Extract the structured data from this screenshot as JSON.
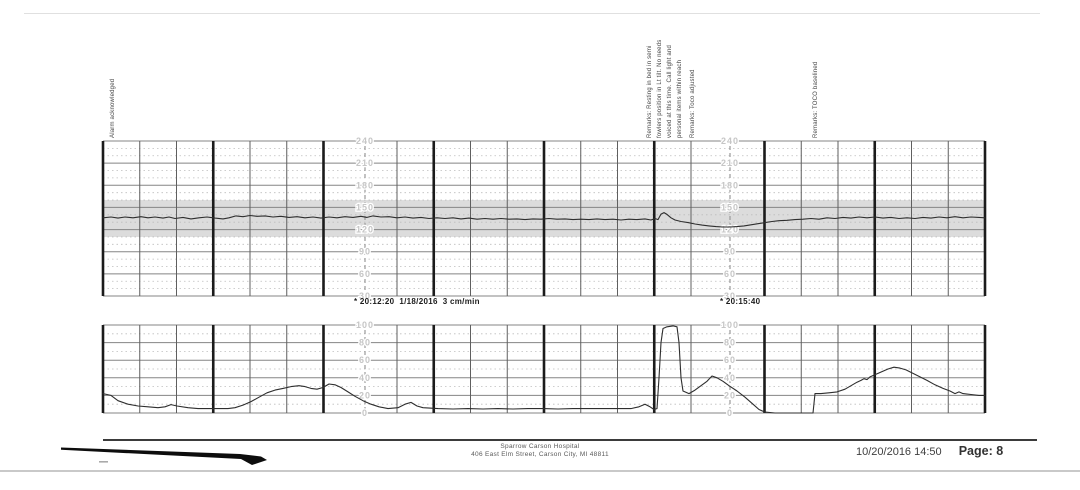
{
  "page": {
    "kind": "Scanned fetal monitoring strip printout",
    "annotations": {
      "alarm": "Alarm acknowledged",
      "remarks_block": [
        "Remarks: Resting in bed in semi",
        "fowlers position in Lt tilt. No needs",
        "voiced at this time. Call light and",
        "personal items within reach",
        "Remarks: Toco adjusted"
      ],
      "toco_baseline": "Remarks: TOCO baselined"
    },
    "strip_labels": {
      "timestamp_left": "* 20:12:20  1/18/2016  3 cm/min",
      "timestamp_right": "* 20:15:40"
    },
    "footer": {
      "hospital_name": "Sparrow Carson Hospital",
      "hospital_address": "406 East Elm Street, Carson City, MI  48811",
      "print_datetime": "10/20/2016 14:50",
      "page_label": "Page: 8"
    }
  },
  "chart_data": [
    {
      "id": "fhr",
      "name": "Fetal heart rate (FHR) strip",
      "type": "line",
      "unit": "bpm",
      "ylim": [
        30,
        240
      ],
      "y_major_ticks": [
        240,
        210,
        180,
        150,
        120,
        90,
        60,
        30
      ],
      "y_minor_step": 10,
      "normal_band": [
        110,
        160
      ],
      "band_color": "#dcdcdc",
      "paper_speed": "3 cm/min",
      "x_major_interval": "1 min",
      "x_minor_interval": "20 s",
      "x_range": [
        0,
        882
      ],
      "x_grid": {
        "major_count": 8,
        "minor_per_major": 3
      },
      "dashed_x": [
        262,
        627
      ],
      "dashed_x_times": [
        "20:12:20",
        "20:15:40"
      ],
      "trace_color": "#2e2e2e",
      "grid_colors": {
        "major_h": "#858585",
        "minor_h": "#bdbdbd",
        "major_v": "#1b1b1b",
        "minor_v": "#5f5f5f",
        "dashed": "#9a9a9a"
      },
      "series": [
        {
          "name": "FHR",
          "points": [
            [
              0,
              136
            ],
            [
              8,
              137
            ],
            [
              15,
              135.5
            ],
            [
              22,
              137
            ],
            [
              30,
              136
            ],
            [
              38,
              137.5
            ],
            [
              45,
              136
            ],
            [
              52,
              137
            ],
            [
              60,
              135.5
            ],
            [
              66,
              137
            ],
            [
              72,
              135
            ],
            [
              80,
              136.5
            ],
            [
              88,
              134.5
            ],
            [
              96,
              136
            ],
            [
              104,
              137
            ],
            [
              112,
              135.5
            ],
            [
              120,
              134.5
            ],
            [
              126,
              136
            ],
            [
              133,
              138.5
            ],
            [
              140,
              137.5
            ],
            [
              147,
              139
            ],
            [
              154,
              138
            ],
            [
              162,
              138.5
            ],
            [
              170,
              137
            ],
            [
              178,
              138
            ],
            [
              186,
              136.5
            ],
            [
              194,
              137.5
            ],
            [
              202,
              136
            ],
            [
              210,
              137
            ],
            [
              218,
              135.5
            ],
            [
              226,
              137
            ],
            [
              234,
              136
            ],
            [
              242,
              137.5
            ],
            [
              250,
              136.5
            ],
            [
              258,
              138
            ],
            [
              264,
              136.5
            ],
            [
              270,
              138.5
            ],
            [
              278,
              137
            ],
            [
              286,
              137.5
            ],
            [
              294,
              136
            ],
            [
              302,
              137
            ],
            [
              310,
              135.5
            ],
            [
              318,
              136.5
            ],
            [
              326,
              135
            ],
            [
              334,
              136
            ],
            [
              342,
              135
            ],
            [
              350,
              136
            ],
            [
              358,
              134.5
            ],
            [
              366,
              135.5
            ],
            [
              374,
              134
            ],
            [
              382,
              135
            ],
            [
              390,
              134
            ],
            [
              398,
              135
            ],
            [
              406,
              134
            ],
            [
              414,
              134.5
            ],
            [
              422,
              133.5
            ],
            [
              430,
              134.5
            ],
            [
              438,
              134
            ],
            [
              446,
              135
            ],
            [
              454,
              134
            ],
            [
              462,
              134.5
            ],
            [
              470,
              133.5
            ],
            [
              478,
              134
            ],
            [
              486,
              133.5
            ],
            [
              494,
              134.5
            ],
            [
              502,
              133.5
            ],
            [
              510,
              134
            ],
            [
              518,
              133
            ],
            [
              526,
              134
            ],
            [
              534,
              133.5
            ],
            [
              542,
              134.5
            ],
            [
              548,
              133
            ],
            [
              552,
              135
            ],
            [
              555,
              133.5
            ],
            [
              558,
              141
            ],
            [
              561,
              143
            ],
            [
              564,
              140.5
            ],
            [
              568,
              136
            ],
            [
              572,
              133
            ],
            [
              578,
              131
            ],
            [
              585,
              129.5
            ],
            [
              592,
              127.5
            ],
            [
              599,
              126
            ],
            [
              606,
              125
            ],
            [
              613,
              124
            ],
            [
              620,
              123.5
            ],
            [
              627,
              123.5
            ],
            [
              634,
              124
            ],
            [
              641,
              125
            ],
            [
              648,
              126.5
            ],
            [
              655,
              128
            ],
            [
              662,
              129.5
            ],
            [
              669,
              131
            ],
            [
              676,
              132
            ],
            [
              684,
              132.5
            ],
            [
              692,
              133.5
            ],
            [
              700,
              134
            ],
            [
              708,
              135
            ],
            [
              716,
              134
            ],
            [
              724,
              136
            ],
            [
              732,
              135
            ],
            [
              740,
              136.5
            ],
            [
              748,
              135.5
            ],
            [
              756,
              137
            ],
            [
              764,
              136
            ],
            [
              772,
              137
            ],
            [
              780,
              135.5
            ],
            [
              788,
              136.5
            ],
            [
              796,
              135
            ],
            [
              804,
              136
            ],
            [
              812,
              135
            ],
            [
              820,
              136.5
            ],
            [
              828,
              135.5
            ],
            [
              836,
              137
            ],
            [
              844,
              136
            ],
            [
              852,
              137.5
            ],
            [
              860,
              136
            ],
            [
              868,
              137
            ],
            [
              876,
              136.5
            ],
            [
              882,
              136
            ]
          ]
        }
      ]
    },
    {
      "id": "ua",
      "name": "Uterine activity (TOCO) strip",
      "type": "line",
      "unit": "relative units",
      "ylim": [
        0,
        100
      ],
      "y_major_ticks": [
        100,
        80,
        60,
        40,
        20,
        0
      ],
      "y_minor_step": 10,
      "x_range": [
        0,
        882
      ],
      "x_grid": {
        "major_count": 8,
        "minor_per_major": 3
      },
      "dashed_x": [
        262,
        627
      ],
      "dashed_x_times": [
        "20:12:20",
        "20:15:40"
      ],
      "trace_color": "#2e2e2e",
      "grid_colors": {
        "major_h": "#858585",
        "minor_h": "#bdbdbd",
        "major_v": "#1b1b1b",
        "minor_v": "#5f5f5f",
        "dashed": "#9a9a9a"
      },
      "series": [
        {
          "name": "UA",
          "points": [
            [
              0,
              22
            ],
            [
              8,
              20
            ],
            [
              15,
              14
            ],
            [
              25,
              10
            ],
            [
              35,
              8
            ],
            [
              45,
              7
            ],
            [
              55,
              6
            ],
            [
              62,
              7
            ],
            [
              68,
              9.5
            ],
            [
              74,
              8
            ],
            [
              85,
              6
            ],
            [
              95,
              5
            ],
            [
              110,
              5
            ],
            [
              125,
              5
            ],
            [
              132,
              6
            ],
            [
              140,
              9
            ],
            [
              148,
              13
            ],
            [
              156,
              18
            ],
            [
              164,
              23
            ],
            [
              172,
              26
            ],
            [
              180,
              28
            ],
            [
              188,
              30
            ],
            [
              196,
              31
            ],
            [
              202,
              30
            ],
            [
              208,
              28
            ],
            [
              214,
              27
            ],
            [
              220,
              29
            ],
            [
              226,
              33
            ],
            [
              232,
              32
            ],
            [
              238,
              29
            ],
            [
              245,
              24
            ],
            [
              252,
              19
            ],
            [
              260,
              14
            ],
            [
              268,
              10
            ],
            [
              276,
              7
            ],
            [
              285,
              5
            ],
            [
              295,
              6
            ],
            [
              302,
              10
            ],
            [
              308,
              12
            ],
            [
              314,
              8
            ],
            [
              320,
              6
            ],
            [
              335,
              5
            ],
            [
              350,
              4.5
            ],
            [
              365,
              5
            ],
            [
              380,
              4.5
            ],
            [
              395,
              5
            ],
            [
              410,
              4.5
            ],
            [
              425,
              5
            ],
            [
              440,
              5
            ],
            [
              455,
              4.5
            ],
            [
              470,
              5
            ],
            [
              485,
              5
            ],
            [
              500,
              5
            ],
            [
              515,
              5
            ],
            [
              528,
              5
            ],
            [
              536,
              7
            ],
            [
              542,
              10
            ],
            [
              547,
              7
            ],
            [
              551,
              4
            ],
            [
              554,
              5
            ],
            [
              556,
              40
            ],
            [
              558,
              80
            ],
            [
              560,
              96
            ],
            [
              564,
              98
            ],
            [
              570,
              99
            ],
            [
              574,
              98
            ],
            [
              576,
              80
            ],
            [
              578,
              40
            ],
            [
              580,
              25
            ],
            [
              586,
              22
            ],
            [
              592,
              26
            ],
            [
              598,
              31
            ],
            [
              604,
              36
            ],
            [
              609,
              42
            ],
            [
              614,
              40
            ],
            [
              620,
              36
            ],
            [
              626,
              31
            ],
            [
              634,
              25
            ],
            [
              642,
              18
            ],
            [
              650,
              10
            ],
            [
              656,
              4
            ],
            [
              662,
              1
            ],
            [
              672,
              0
            ],
            [
              690,
              0
            ],
            [
              710,
              0
            ],
            [
              712,
              22
            ],
            [
              718,
              22
            ],
            [
              726,
              23
            ],
            [
              734,
              24
            ],
            [
              742,
              27
            ],
            [
              748,
              31
            ],
            [
              754,
              35
            ],
            [
              758,
              37
            ],
            [
              761,
              39
            ],
            [
              764,
              38
            ],
            [
              767,
              41
            ],
            [
              773,
              44
            ],
            [
              779,
              47
            ],
            [
              785,
              50
            ],
            [
              791,
              52
            ],
            [
              797,
              51
            ],
            [
              803,
              49
            ],
            [
              810,
              45
            ],
            [
              817,
              41
            ],
            [
              824,
              37
            ],
            [
              832,
              32
            ],
            [
              840,
              28
            ],
            [
              847,
              25
            ],
            [
              852,
              22
            ],
            [
              856,
              24
            ],
            [
              860,
              22
            ],
            [
              868,
              21
            ],
            [
              876,
              20
            ],
            [
              882,
              20
            ]
          ]
        }
      ]
    }
  ]
}
